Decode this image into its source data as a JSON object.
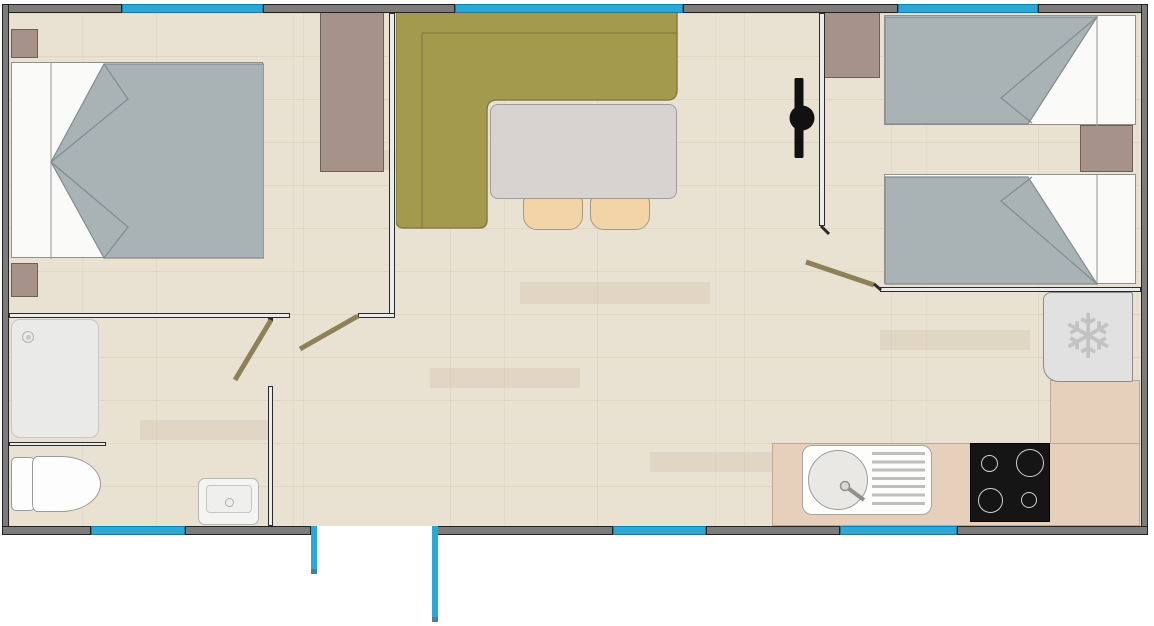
{
  "plan": {
    "kind": "mobile-home floor plan, top view",
    "rooms": [
      "double bedroom",
      "living-dining area",
      "twin bedroom",
      "shower room",
      "wc",
      "kitchen"
    ]
  },
  "icons": {
    "fridge_snowflake": "❄"
  },
  "palette": {
    "outer_wall": "#7c7c7c",
    "wall_outline": "#222222",
    "window": "#2aa9d8",
    "exterior_door": "#2aa9d8",
    "interior_door_panel": "#8e8157",
    "floor_base": "#e9e2d3",
    "sofa": "#a49a4d",
    "table": "#d7d3d0",
    "chair": "#f2d4a6",
    "bed_blanket": "#a9b3b6",
    "bed_sheet": "#fafaf9",
    "wood_furniture": "#a79289",
    "counter": "#e6d0bb",
    "fridge": "#e1e1e1",
    "stove": "#151515",
    "tv": "#111111",
    "sanitary_white": "#fdfdfd",
    "shower_tray": "#eaeae8"
  }
}
